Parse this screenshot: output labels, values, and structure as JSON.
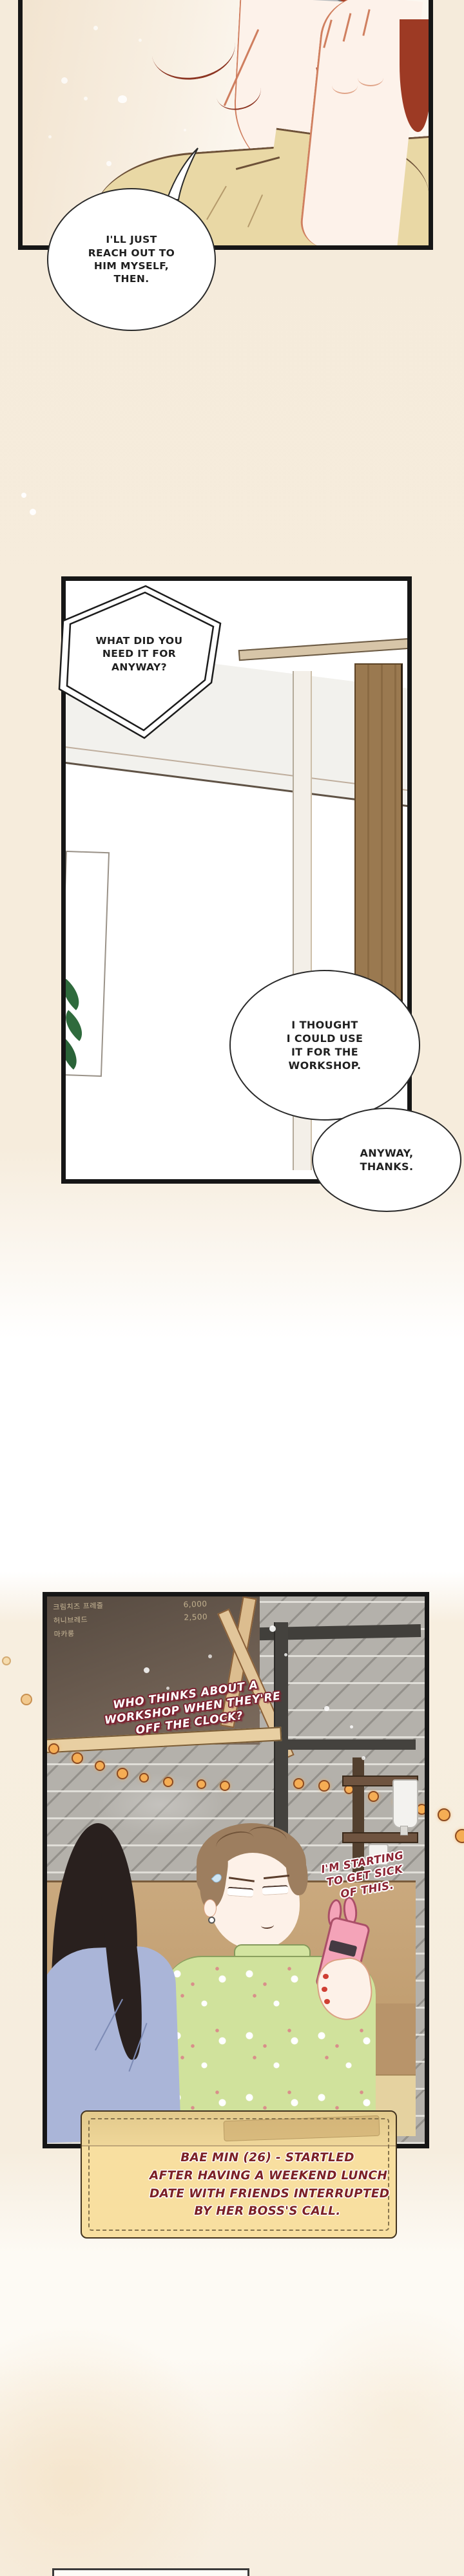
{
  "colors": {
    "panel_border": "#161616",
    "page_cream": "#f6ecdc",
    "bubble_fill": "#ffffff",
    "bubble_stroke": "#2a2a2a",
    "caption_bg": "#f8dfa0",
    "caption_text": "#7c2126",
    "shout_outline": "#7c2231",
    "murmur_text": "#8c2433",
    "string_light": "#f5ad54",
    "hair_red": "#a64028",
    "hair_brown": "#9d7e5f",
    "shirt_tan": "#e9d8a5",
    "blouse_green": "#d0e29c",
    "phone_pink": "#f4a3b8",
    "friend_blue": "#aab5d8"
  },
  "panel1": {
    "bubble": {
      "lines": [
        "I'LL JUST",
        "REACH OUT TO",
        "HIM MYSELF,",
        "THEN."
      ]
    }
  },
  "panel2": {
    "hex_bubble": {
      "lines": [
        "WHAT DID YOU",
        "NEED IT FOR",
        "ANYWAY?"
      ]
    },
    "bubble_workshop": {
      "lines": [
        "I THOUGHT",
        "I COULD USE",
        "IT FOR THE",
        "WORKSHOP."
      ]
    },
    "bubble_thanks": {
      "lines": [
        "ANYWAY,",
        "THANKS."
      ]
    }
  },
  "panel3": {
    "menu_board": {
      "item_1": "크림치즈 프레즐",
      "item_2": "허니브레드",
      "item_3": "마카롱",
      "price_1": "6,000",
      "price_2": "2,500"
    },
    "shout": {
      "lines": [
        "WHO THINKS ABOUT A",
        "WORKSHOP WHEN THEY'RE",
        "OFF THE CLOCK?"
      ]
    },
    "murmur": {
      "lines": [
        "I'M STARTING",
        "TO GET SICK",
        "OF THIS."
      ]
    },
    "caption": {
      "lines": [
        "BAE MIN (26) - STARTLED",
        "AFTER HAVING A WEEKEND LUNCH",
        "DATE WITH FRIENDS INTERRUPTED",
        "BY HER BOSS'S CALL."
      ]
    }
  }
}
